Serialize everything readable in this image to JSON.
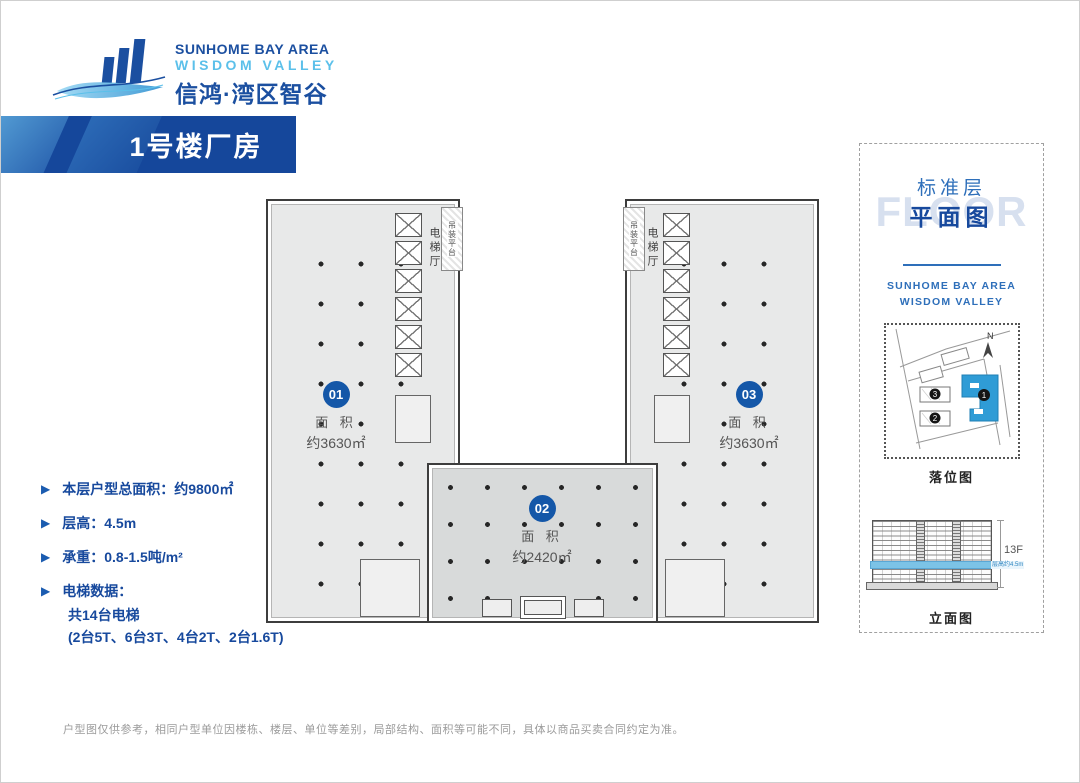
{
  "logo": {
    "en_line1": "SUNHOME BAY AREA",
    "en_line2": "WISDOM VALLEY",
    "cn": "信鸿·湾区智谷"
  },
  "banner": {
    "title": "1号楼厂房"
  },
  "specs": {
    "items": [
      {
        "label": "本层户型总面积：约9800㎡"
      },
      {
        "label": "层高：4.5m"
      },
      {
        "label": "承重：0.8-1.5吨/m²"
      },
      {
        "label": "电梯数据：",
        "sublines": [
          "共14台电梯",
          "(2台5T、6台3T、4台2T、2台1.6T)"
        ]
      }
    ]
  },
  "floorplan": {
    "units": [
      {
        "id": "01",
        "area_label": "面 积",
        "area_value": "约3630㎡"
      },
      {
        "id": "02",
        "area_label": "面 积",
        "area_value": "约2420㎡"
      },
      {
        "id": "03",
        "area_label": "面 积",
        "area_value": "约3630㎡"
      }
    ],
    "elevator_hall_left": "电梯厅",
    "elevator_hall_right": "电梯厅",
    "hoist_platform_left": "吊装平台",
    "hoist_platform_right": "吊装平台"
  },
  "side_panel": {
    "ghost_text": "FLOOR",
    "title_cn_line1": "标准层",
    "title_cn_line2": "平面图",
    "brand_line1": "SUNHOME BAY AREA",
    "brand_line2": "WISDOM VALLEY",
    "sitemap": {
      "caption": "落位图",
      "north_label": "N",
      "building_numbers": [
        "1",
        "2",
        "3"
      ]
    },
    "elevation": {
      "caption": "立面图",
      "floors_label": "13F",
      "highlight_label": "层高约4.5m"
    }
  },
  "disclaimer": "户型图仅供参考，相同户型单位因楼栋、楼层、单位等差别，局部结构、面积等可能不同，具体以商品买卖合同约定为准。",
  "colors": {
    "primary_blue": "#16489c",
    "light_blue": "#5bc0ea",
    "unit_badge_blue": "#1457a8",
    "map_building_blue": "#2f9cd6",
    "elevation_highlight": "#7cc3e6",
    "plan_fill": "#e8e9e9",
    "plan_center_fill": "#d8dada"
  }
}
